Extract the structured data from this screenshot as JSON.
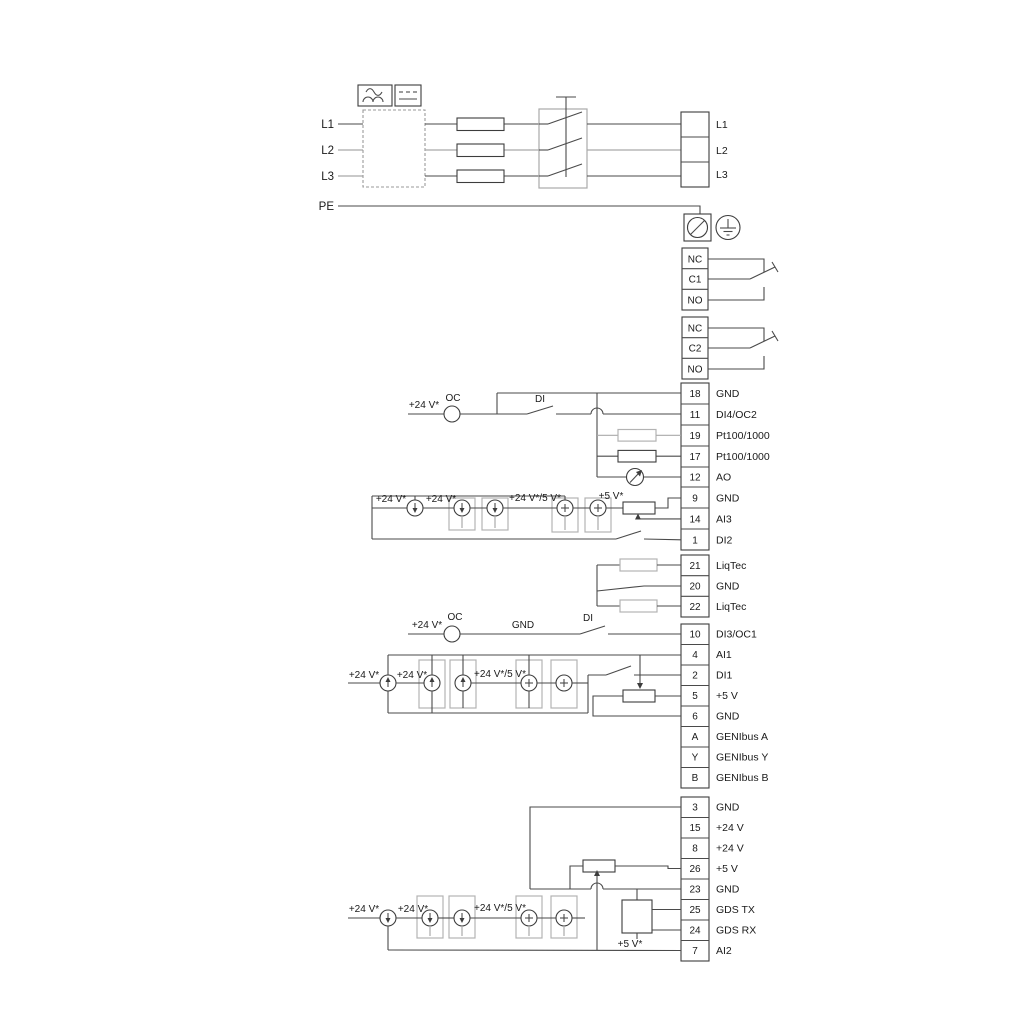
{
  "power": {
    "inputs": [
      "L1",
      "L2",
      "L3",
      "PE"
    ],
    "outputs": [
      "L1",
      "L2",
      "L3"
    ]
  },
  "relays": {
    "r1": [
      "NC",
      "C1",
      "NO"
    ],
    "r2": [
      "NC",
      "C2",
      "NO"
    ]
  },
  "strips": {
    "g1": [
      [
        "18",
        "GND"
      ],
      [
        "11",
        "DI4/OC2"
      ],
      [
        "19",
        "Pt100/1000"
      ],
      [
        "17",
        "Pt100/1000"
      ],
      [
        "12",
        "AO"
      ],
      [
        "9",
        "GND"
      ],
      [
        "14",
        "AI3"
      ],
      [
        "1",
        "DI2"
      ]
    ],
    "g2": [
      [
        "21",
        "LiqTec"
      ],
      [
        "20",
        "GND"
      ],
      [
        "22",
        "LiqTec"
      ]
    ],
    "g3": [
      [
        "10",
        "DI3/OC1"
      ],
      [
        "4",
        "AI1"
      ],
      [
        "2",
        "DI1"
      ],
      [
        "5",
        "+5 V"
      ],
      [
        "6",
        "GND"
      ],
      [
        "A",
        "GENIbus A"
      ],
      [
        "Y",
        "GENIbus Y"
      ],
      [
        "B",
        "GENIbus B"
      ]
    ],
    "g4": [
      [
        "3",
        "GND"
      ],
      [
        "15",
        "+24 V"
      ],
      [
        "8",
        "+24 V"
      ],
      [
        "26",
        "+5 V"
      ],
      [
        "23",
        "GND"
      ],
      [
        "25",
        "GDS TX"
      ],
      [
        "24",
        "GDS RX"
      ],
      [
        "7",
        "AI2"
      ]
    ]
  },
  "ann": {
    "g1_v24": "+24 V*",
    "g1_oc": "OC",
    "g1_di": "DI",
    "ai3_v24a": "+24 V*",
    "ai3_v24b": "+24 V*",
    "ai3_mix": "+24 V*/5 V*",
    "ai3_v5": "+5 V*",
    "di3_v24": "+24 V*",
    "di3_oc": "OC",
    "di3_gnd": "GND",
    "di3_di": "DI",
    "ai1_v24a": "+24 V*",
    "ai1_v24b": "+24 V*",
    "ai1_mix": "+24 V*/5 V*",
    "ai2_v24a": "+24 V*",
    "ai2_v24b": "+24 V*",
    "ai2_mix": "+24 V*/5 V*",
    "ai2_v5": "+5 V*"
  },
  "colors": {
    "wire": "#4a4a4a",
    "muted": "#a9a9a9",
    "text": "#1a1a1a"
  }
}
